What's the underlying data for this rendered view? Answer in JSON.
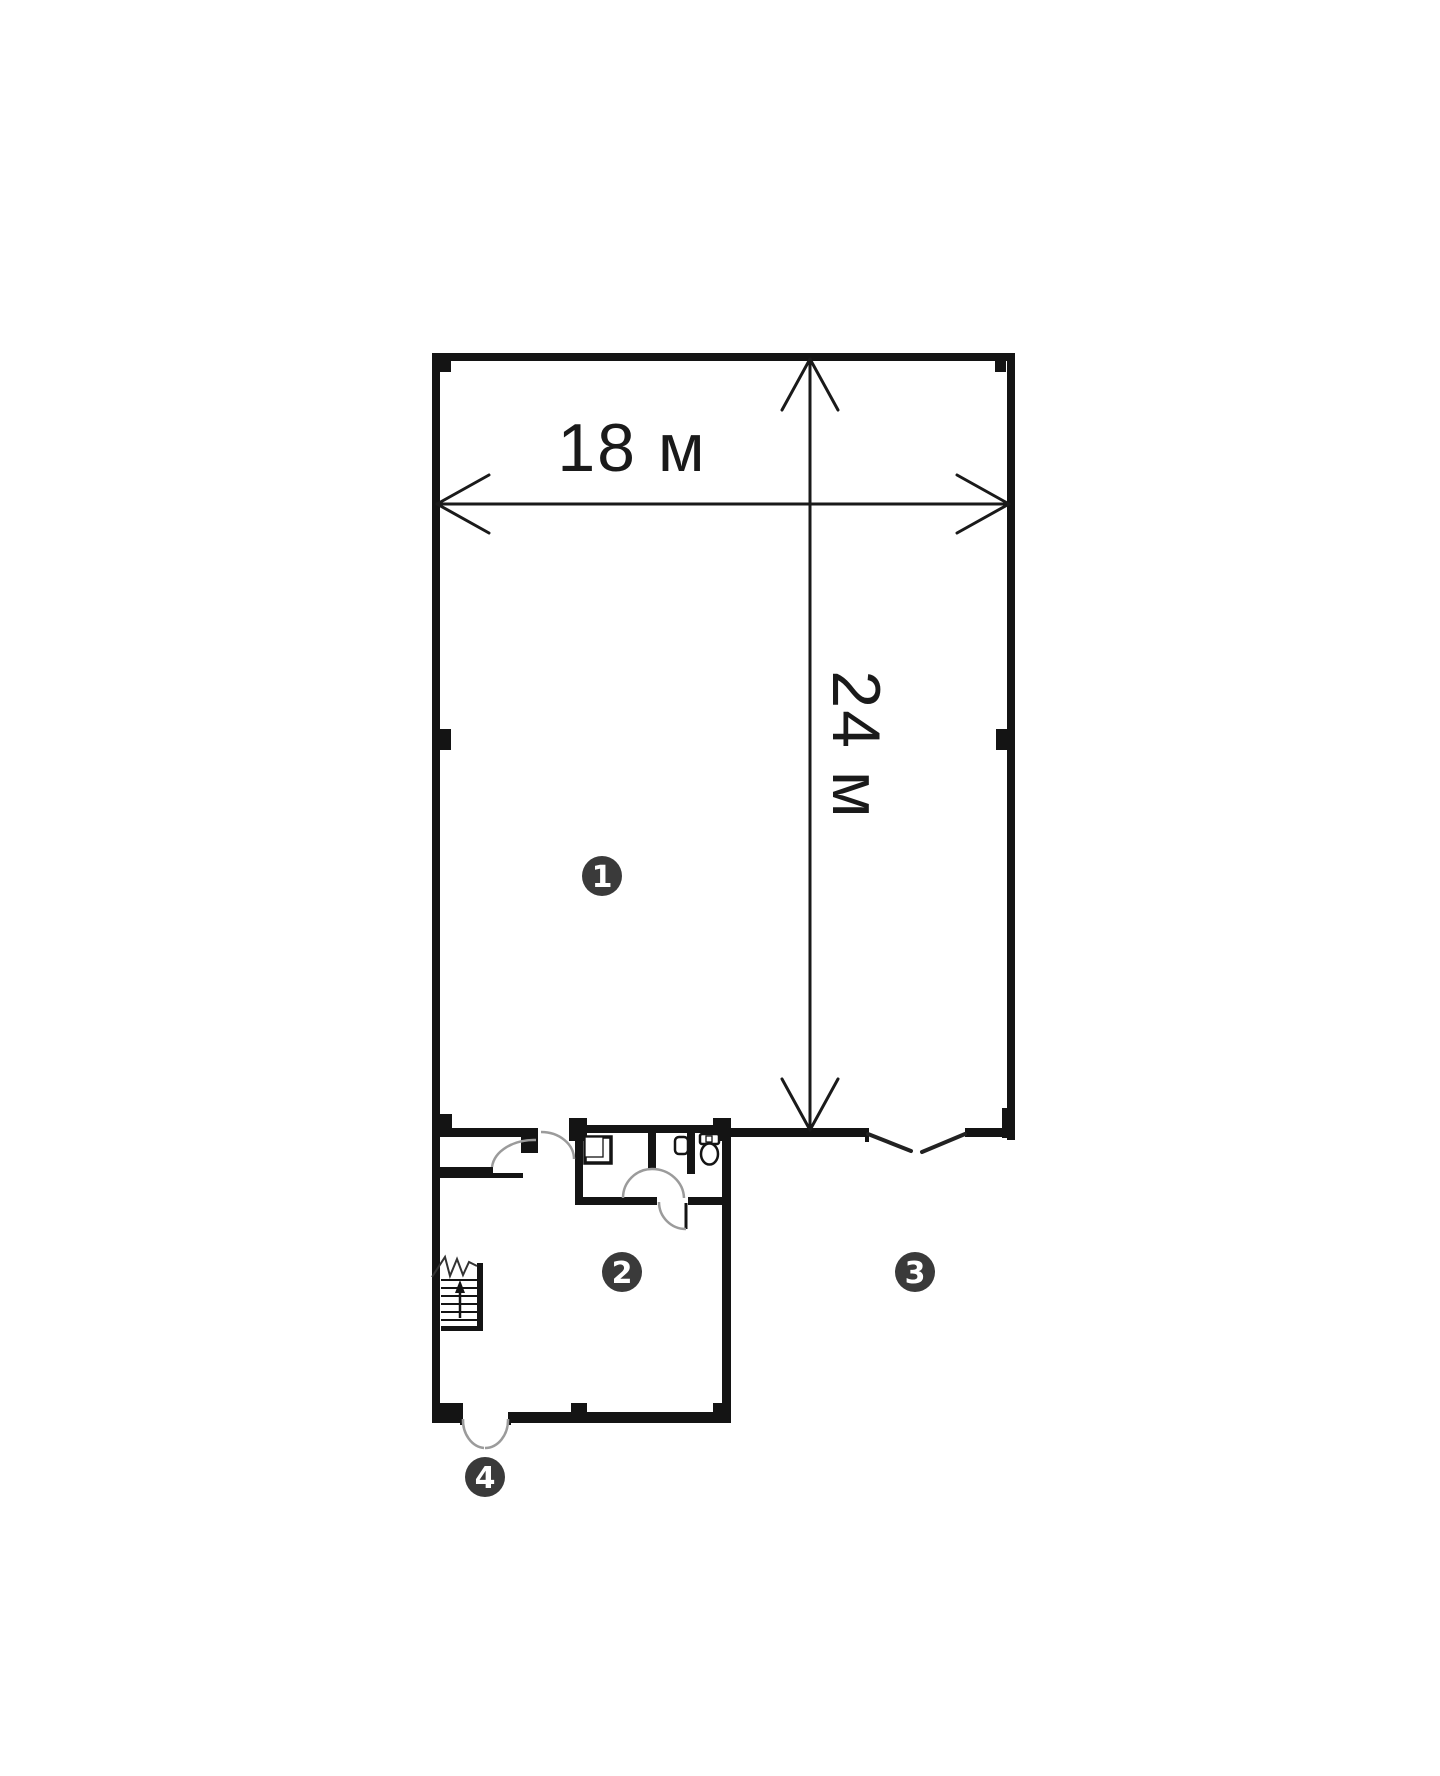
{
  "plan": {
    "type": "floor-plan",
    "dimension_width_label": "18 м",
    "dimension_height_label": "24 м",
    "markers": [
      {
        "label": "1"
      },
      {
        "label": "2"
      },
      {
        "label": "3"
      },
      {
        "label": "4"
      }
    ],
    "icons": {
      "stairs": "stairs-icon",
      "stairs_direction": "up-arrow-icon",
      "toilet": "toilet-icon",
      "sink": "sink-icon",
      "urinal": "urinal-icon",
      "interior_doors": "door-swing-arc-icon",
      "main_entrance": "double-door-arc-icon",
      "side_opening": "double-door-leaf-icon"
    },
    "colors": {
      "background": "#ffffff",
      "walls": "#141414",
      "dimension_lines": "#1a1a1a",
      "door_arcs": "#9b9b9b",
      "marker_fill": "#3a3a3a",
      "marker_text": "#ffffff"
    }
  }
}
